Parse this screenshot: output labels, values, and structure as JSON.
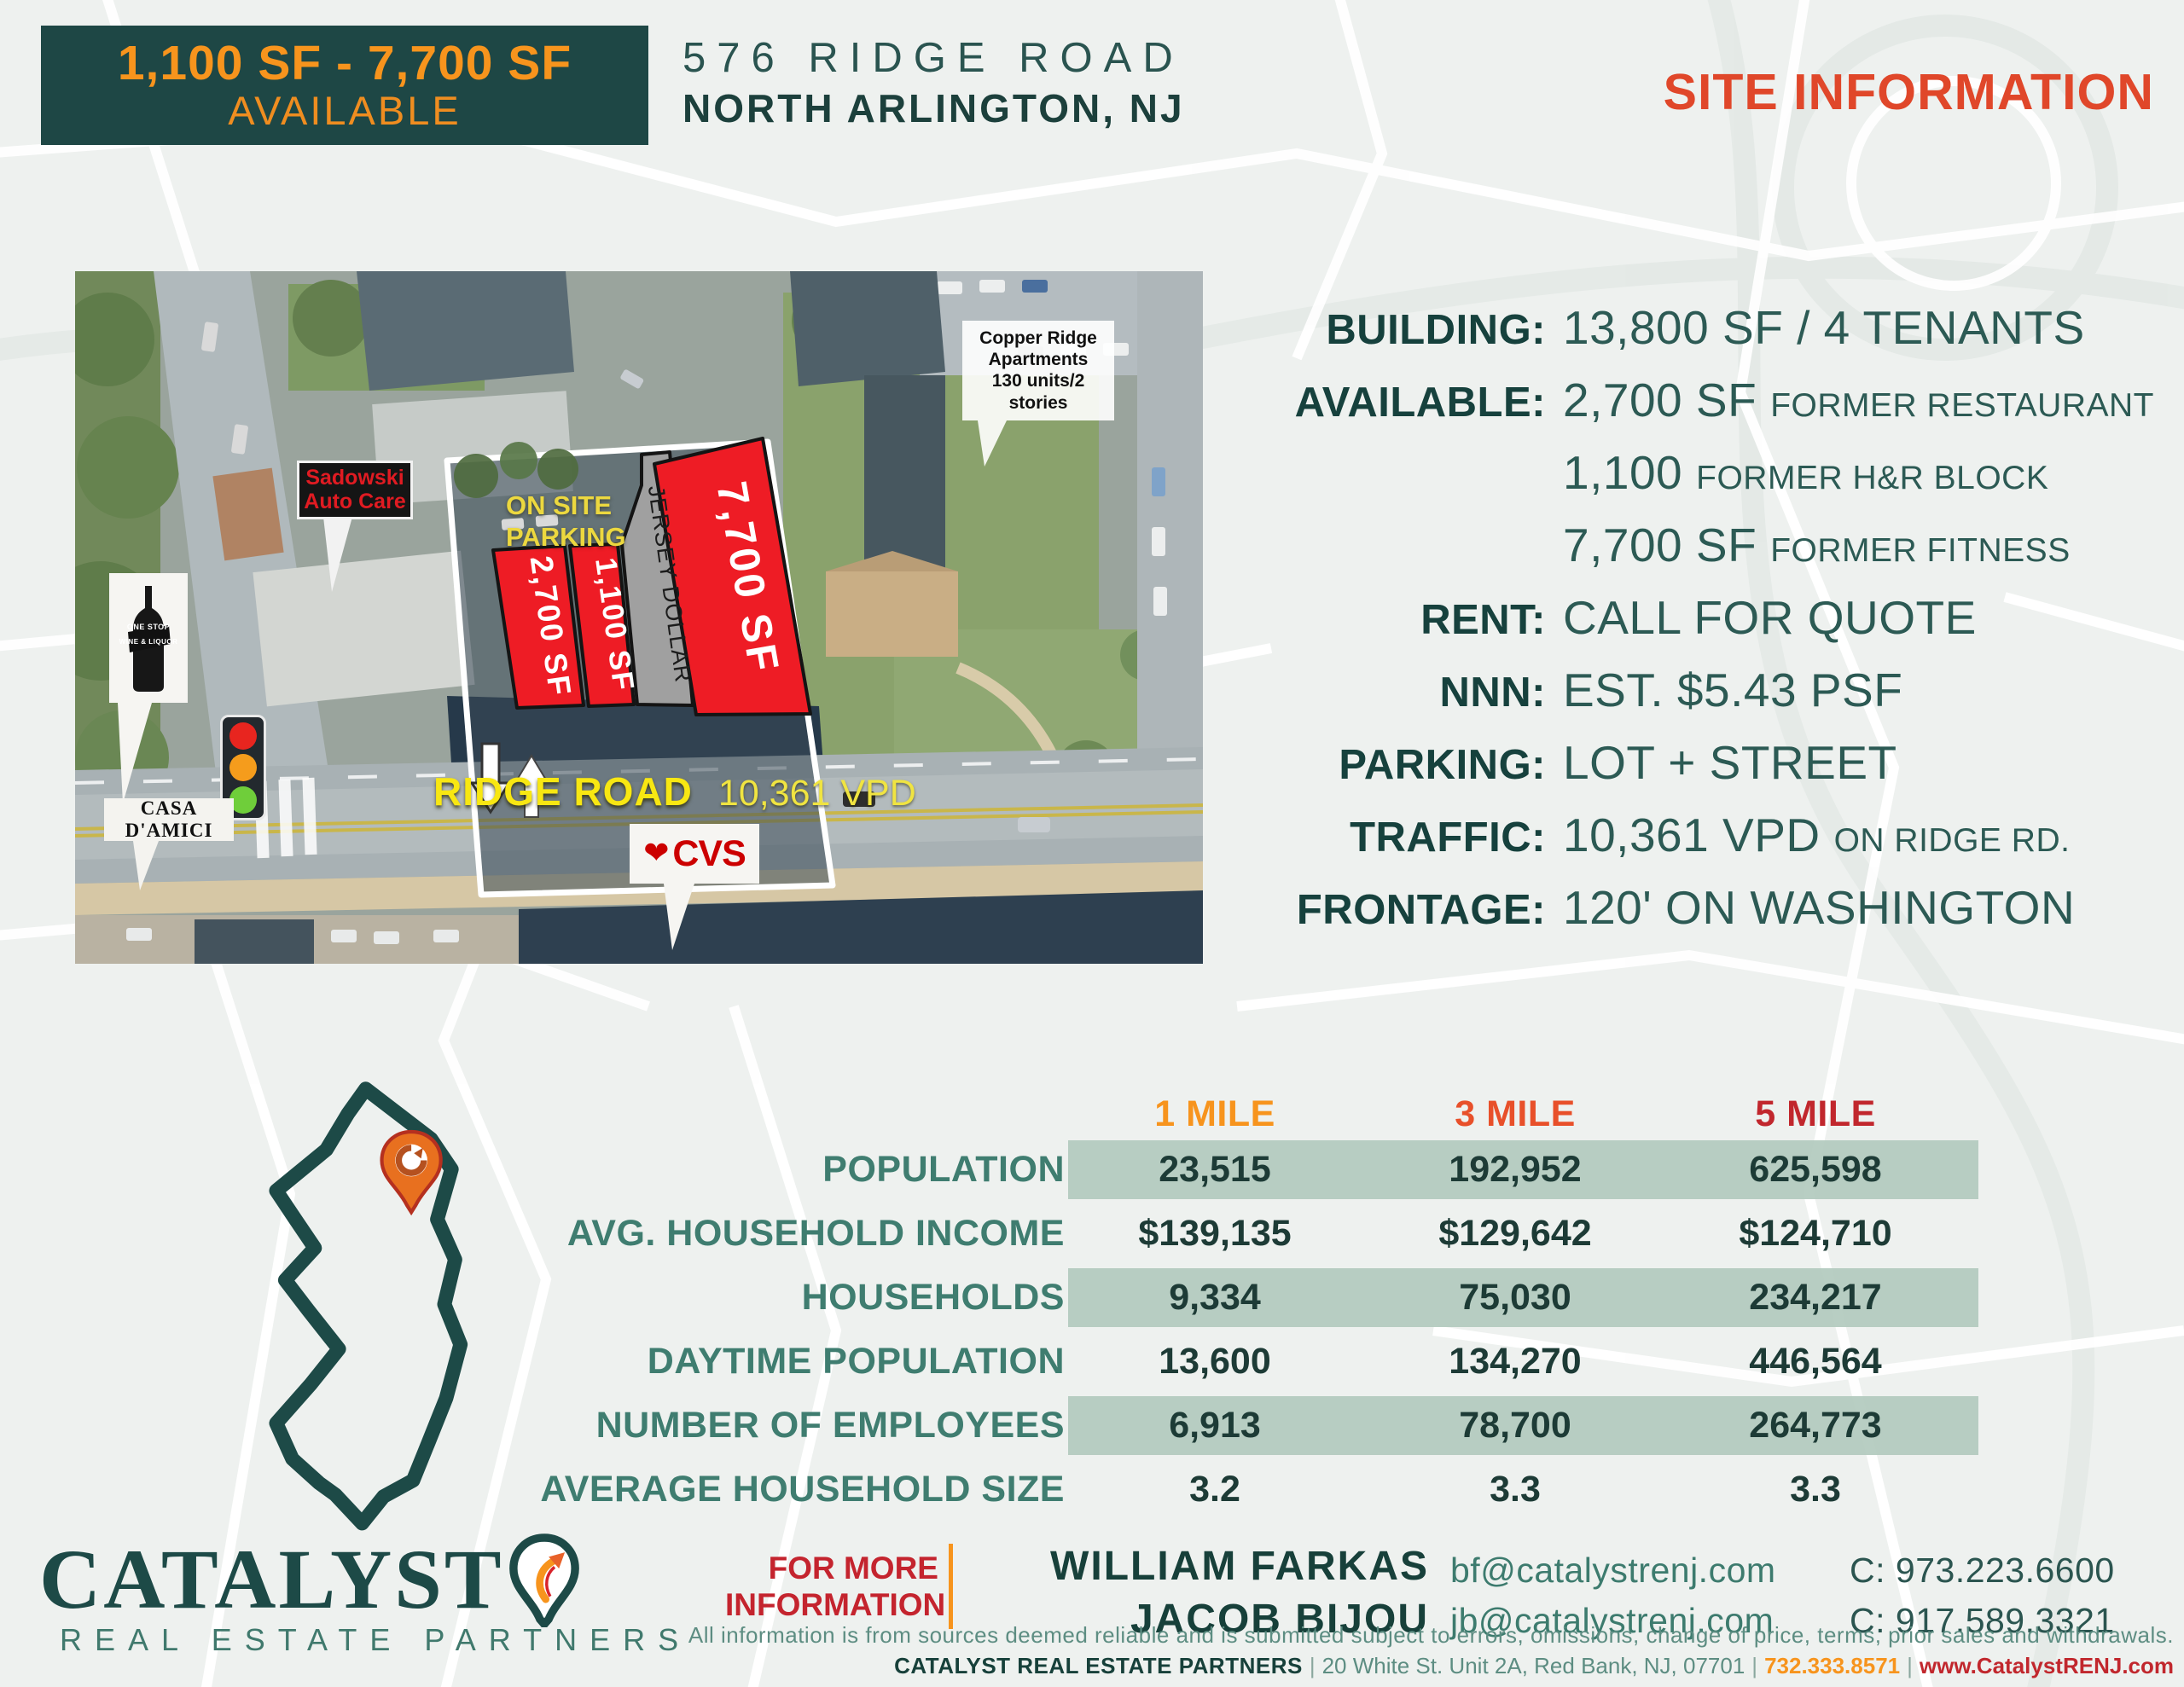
{
  "header": {
    "banner": {
      "line1": "1,100 SF - 7,700 SF",
      "line2": "AVAILABLE"
    },
    "address_line1": "576 RIDGE ROAD",
    "address_line2": "NORTH ARLINGTON, NJ",
    "site_info_title": "SITE INFORMATION"
  },
  "map": {
    "signs": {
      "copper_ridge": {
        "line1": "Copper Ridge",
        "line2": "Apartments",
        "line3": "130 units/2 stories"
      },
      "sadowski": {
        "line1": "Sadowski",
        "line2": "Auto Care"
      },
      "on_site_parking": {
        "line1": "ON SITE",
        "line2": "PARKING"
      },
      "wine_shop": {
        "line1": "ONE STOP",
        "line2": "WINE & LIQUOR"
      },
      "casa_damici": {
        "label": "CASA D'AMICI"
      },
      "cvs": {
        "label": "CVS"
      }
    },
    "road": {
      "name": "RIDGE ROAD",
      "traffic": "10,361 VPD"
    },
    "parcels": {
      "p2700": {
        "label": "2,700 SF"
      },
      "p1100": {
        "label": "1,100 SF"
      },
      "jersey": {
        "label": "JERSEY DOLLAR"
      },
      "p7700": {
        "label": "7,700 SF"
      }
    }
  },
  "site_info": {
    "rows": [
      {
        "label": "BUILDING:",
        "value": "13,800 SF / 4 TENANTS",
        "suffix": ""
      },
      {
        "label": "AVAILABLE:",
        "value": "2,700 SF",
        "suffix": "FORMER RESTAURANT"
      },
      {
        "label": "",
        "value": "1,100",
        "suffix": "FORMER H&R BLOCK"
      },
      {
        "label": "",
        "value": "7,700 SF",
        "suffix": "FORMER FITNESS"
      },
      {
        "label": "RENT:",
        "value": "CALL FOR QUOTE",
        "suffix": ""
      },
      {
        "label": "NNN:",
        "value": "EST. $5.43 PSF",
        "suffix": ""
      },
      {
        "label": "PARKING:",
        "value": "LOT + STREET",
        "suffix": ""
      },
      {
        "label": "TRAFFIC:",
        "value": "10,361 VPD",
        "suffix": "ON RIDGE RD."
      },
      {
        "label": "FRONTAGE:",
        "value": "120' ON WASHINGTON",
        "suffix": ""
      }
    ]
  },
  "demographics": {
    "columns": [
      "1 MILE",
      "3 MILE",
      "5 MILE"
    ],
    "column_colors": [
      "#f7941d",
      "#e8502a",
      "#c1272d"
    ],
    "rows": [
      {
        "label": "POPULATION",
        "values": [
          "23,515",
          "192,952",
          "625,598"
        ],
        "banded": true
      },
      {
        "label": "AVG. HOUSEHOLD INCOME",
        "values": [
          "$139,135",
          "$129,642",
          "$124,710"
        ],
        "banded": false
      },
      {
        "label": "HOUSEHOLDS",
        "values": [
          "9,334",
          "75,030",
          "234,217"
        ],
        "banded": true
      },
      {
        "label": "DAYTIME POPULATION",
        "values": [
          "13,600",
          "134,270",
          "446,564"
        ],
        "banded": false
      },
      {
        "label": "NUMBER OF EMPLOYEES",
        "values": [
          "6,913",
          "78,700",
          "264,773"
        ],
        "banded": true
      },
      {
        "label": "AVERAGE HOUSEHOLD SIZE",
        "values": [
          "3.2",
          "3.3",
          "3.3"
        ],
        "banded": false
      }
    ]
  },
  "footer": {
    "logo": {
      "name": "CATALYST",
      "subtitle": "REAL ESTATE PARTNERS"
    },
    "more_info": {
      "line1": "FOR MORE",
      "line2": "INFORMATION"
    },
    "contacts": [
      {
        "name": "WILLIAM FARKAS",
        "email": "bf@catalystrenj.com",
        "phone": "C: 973.223.6600"
      },
      {
        "name": "JACOB BIJOU",
        "email": "jb@catalystrenj.com",
        "phone": "C: 917.589.3321"
      }
    ],
    "disclaimer": "All information is from sources deemed reliable and is submitted subject to errors, omissions, change of price, terms, prior sales and withdrawals.",
    "footer_line": {
      "brand": "CATALYST REAL ESTATE PARTNERS",
      "address": "20 White St. Unit 2A, Red Bank, NJ, 07701",
      "phone": "732.333.8571",
      "website": "www.CatalystRENJ.com"
    }
  },
  "colors": {
    "teal_dark": "#1e4745",
    "teal_mid": "#2c5a54",
    "teal_light": "#3f7d70",
    "orange": "#f7941d",
    "red_orange": "#e8502a",
    "red": "#c1272d",
    "crimson": "#c4242e",
    "sage_band": "#b0c9bc",
    "parcel_red": "#ee1c25",
    "map_yellow": "#f5e71c"
  }
}
